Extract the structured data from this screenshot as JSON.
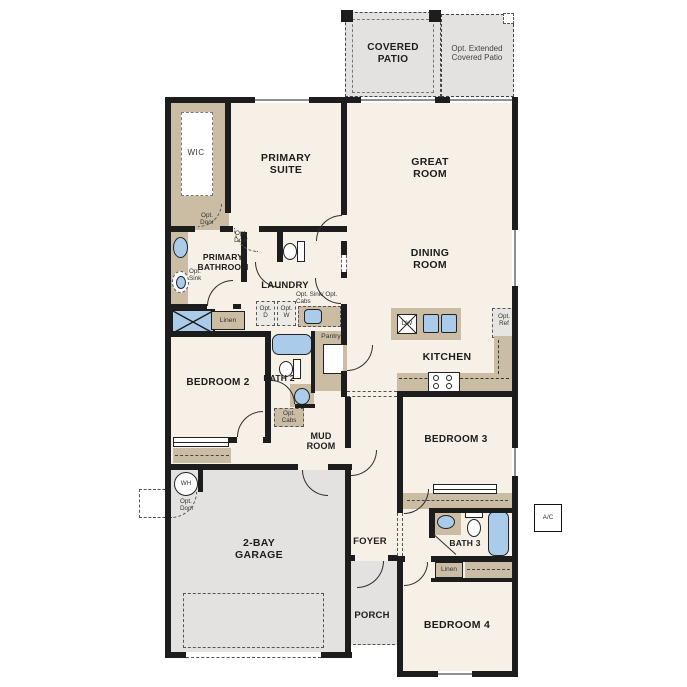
{
  "rooms": {
    "covered_patio": "COVERED PATIO",
    "ext_patio": "Opt. Extended Covered Patio",
    "wic": "WIC",
    "primary_suite": "PRIMARY SUITE",
    "great_room": "GREAT ROOM",
    "dining_room": "DINING ROOM",
    "primary_bathroom": "PRIMARY BATHROOM",
    "laundry": "LAUNDRY",
    "kitchen": "KITCHEN",
    "bedroom2": "BEDROOM 2",
    "bath2": "BATH 2",
    "mud_room": "MUD ROOM",
    "garage": "2-BAY GARAGE",
    "foyer": "FOYER",
    "porch": "PORCH",
    "bedroom3": "BEDROOM 3",
    "bath3": "BATH 3",
    "bedroom4": "BEDROOM 4"
  },
  "labels": {
    "opt_door": "Opt. Door",
    "opt_sink": "Opt. Sink",
    "opt_d": "Opt. D",
    "opt_w": "Opt. W",
    "opt_sink_cabs": "Opt. Sink/ Opt. Cabs",
    "linen": "Linen",
    "pantry": "Pantry",
    "opt_ref": "Opt. Ref",
    "opt_cabs": "Opt. Cabs",
    "wh": "WH",
    "dw": "DW",
    "ac": "A/C"
  },
  "colors": {
    "floor": "#f6f0e6",
    "concrete": "#e3e2e0",
    "casework": "#cbbda4",
    "fixture_blue": "#aacbea",
    "wall": "#1d1d1d"
  }
}
